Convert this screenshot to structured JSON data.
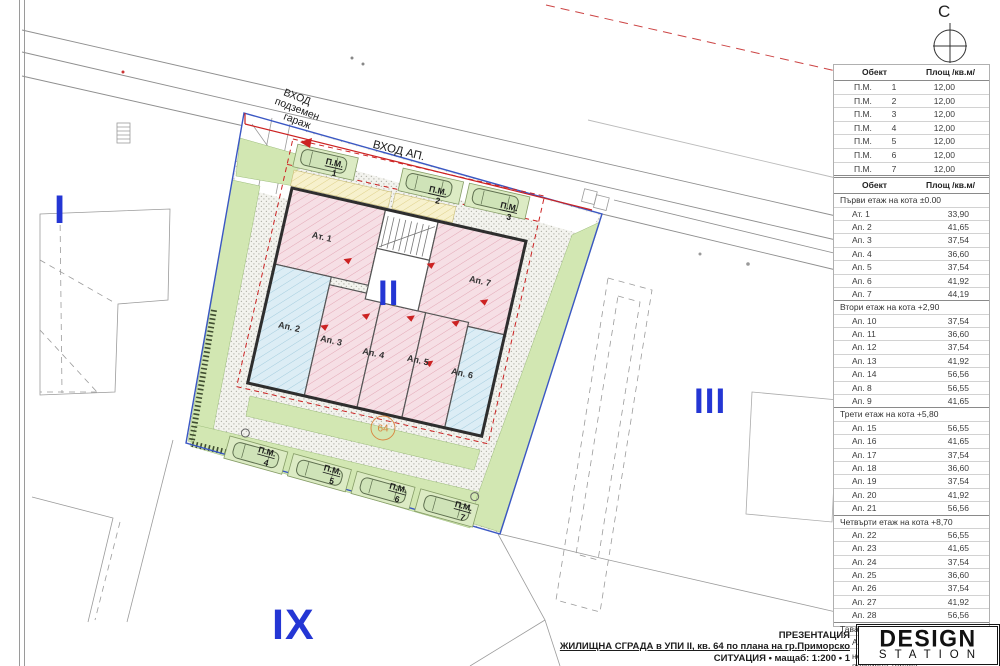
{
  "north_label": "С",
  "plan": {
    "entrance_garage": {
      "line1": "ВХОД",
      "line2": "подземен",
      "line3": "гараж"
    },
    "entrance_apartments_label": "ВХОД АП.",
    "plot_number": "64",
    "zones": {
      "i": "I",
      "ii": "II",
      "iii": "III",
      "ix": "IX"
    },
    "apartments": [
      {
        "label": "Ат. 1"
      },
      {
        "label": "Ап. 2"
      },
      {
        "label": "Ап. 3"
      },
      {
        "label": "Ап. 4"
      },
      {
        "label": "Ап. 5"
      },
      {
        "label": "Ап. 6"
      },
      {
        "label": "Ап. 7"
      }
    ],
    "parking": [
      {
        "label": "П.М.",
        "num": "1"
      },
      {
        "label": "П.М.",
        "num": "2"
      },
      {
        "label": "П.М.",
        "num": "3"
      },
      {
        "label": "П.М.",
        "num": "4"
      },
      {
        "label": "П.М.",
        "num": "5"
      },
      {
        "label": "П.М.",
        "num": "6"
      },
      {
        "label": "П.М.",
        "num": "7"
      }
    ]
  },
  "tables": {
    "parking_table": {
      "col_object": "Обект",
      "col_area": "Площ /кв.м/",
      "rows": [
        {
          "object": "П.М.",
          "num": "1",
          "area": "12,00"
        },
        {
          "object": "П.М.",
          "num": "2",
          "area": "12,00"
        },
        {
          "object": "П.М.",
          "num": "3",
          "area": "12,00"
        },
        {
          "object": "П.М.",
          "num": "4",
          "area": "12,00"
        },
        {
          "object": "П.М.",
          "num": "5",
          "area": "12,00"
        },
        {
          "object": "П.М.",
          "num": "6",
          "area": "12,00"
        },
        {
          "object": "П.М.",
          "num": "7",
          "area": "12,00"
        }
      ]
    },
    "apartments_table": {
      "col_object": "Обект",
      "col_area": "Площ /кв.м/",
      "sections": [
        {
          "title": "Първи етаж на кота ±0.00",
          "rows": [
            {
              "object": "Ат. 1",
              "area": "33,90"
            },
            {
              "object": "Ап. 2",
              "area": "41,65"
            },
            {
              "object": "Ап. 3",
              "area": "37,54"
            },
            {
              "object": "Ап. 4",
              "area": "36,60"
            },
            {
              "object": "Ап. 5",
              "area": "37,54"
            },
            {
              "object": "Ап. 6",
              "area": "41,92"
            },
            {
              "object": "Ап. 7",
              "area": "44,19"
            }
          ]
        },
        {
          "title": "Втори етаж на кота +2,90",
          "rows": [
            {
              "object": "Ап. 10",
              "area": "37,54"
            },
            {
              "object": "Ап. 11",
              "area": "36,60"
            },
            {
              "object": "Ап. 12",
              "area": "37,54"
            },
            {
              "object": "Ап. 13",
              "area": "41,92"
            },
            {
              "object": "Ап. 14",
              "area": "56,56"
            },
            {
              "object": "Ап. 8",
              "area": "56,55"
            },
            {
              "object": "Ап. 9",
              "area": "41,65"
            }
          ]
        },
        {
          "title": "Трети етаж на кота +5,80",
          "rows": [
            {
              "object": "Ап. 15",
              "area": "56,55"
            },
            {
              "object": "Ап. 16",
              "area": "41,65"
            },
            {
              "object": "Ап. 17",
              "area": "37,54"
            },
            {
              "object": "Ап. 18",
              "area": "36,60"
            },
            {
              "object": "Ап. 19",
              "area": "37,54"
            },
            {
              "object": "Ап. 20",
              "area": "41,92"
            },
            {
              "object": "Ап. 21",
              "area": "56,56"
            }
          ]
        },
        {
          "title": "Четвърти етаж на кота +8,70",
          "rows": [
            {
              "object": "Ап. 22",
              "area": "56,55"
            },
            {
              "object": "Ап. 23",
              "area": "41,65"
            },
            {
              "object": "Ап. 24",
              "area": "37,54"
            },
            {
              "object": "Ап. 25",
              "area": "36,60"
            },
            {
              "object": "Ап. 26",
              "area": "37,54"
            },
            {
              "object": "Ап. 27",
              "area": "41,92"
            },
            {
              "object": "Ап. 28",
              "area": "56,56"
            }
          ]
        },
        {
          "title": "Тавански етаж на кота +11,60",
          "rows": [
            {
              "object": "Ап. 29",
              "area": "125,41"
            },
            {
              "object": "неизползваема покривна тераса",
              "area": "201,04",
              "tall": true
            }
          ]
        }
      ]
    }
  },
  "title_block": {
    "line1": "ПРЕЗЕНТАЦИЯ",
    "line2": "ЖИЛИЩНА СГРАДА в УПИ II, кв. 64 по плана на гр.Приморско",
    "line3": "СИТУАЦИЯ • мащаб: 1:200 • 1"
  },
  "logo": {
    "line1": "DESIGN",
    "line2": "STATION"
  },
  "colors": {
    "numeral_blue": "#2436d4",
    "boundary_blue": "#3a57c4",
    "red_line": "#cc2222",
    "lawn_green": "#d2e7b2",
    "apartment_pink": "#f6dfe5",
    "apartment_blue": "#dcedf5",
    "plot_number_orange": "#d9853f"
  }
}
